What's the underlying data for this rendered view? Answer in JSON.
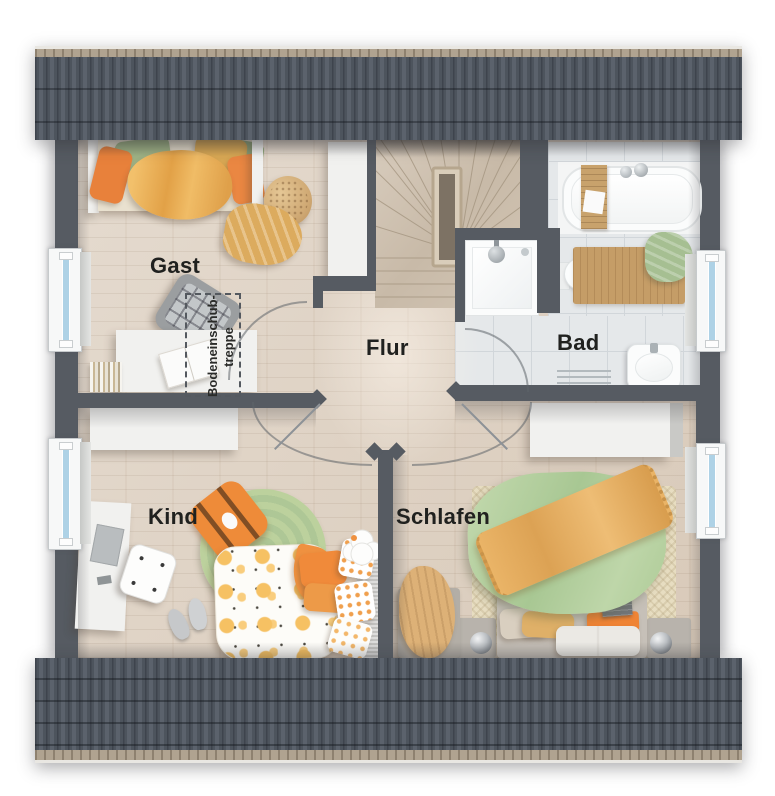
{
  "plan": {
    "rooms": {
      "gast": {
        "label": "Gast"
      },
      "flur": {
        "label": "Flur"
      },
      "bad": {
        "label": "Bad"
      },
      "kind": {
        "label": "Kind"
      },
      "schlafen": {
        "label": "Schlafen"
      }
    },
    "annotations": {
      "attic_stairs": {
        "line1": "Bodeneinschub-",
        "line2": "treppe"
      }
    },
    "colors": {
      "wall": "#565b62",
      "roof_base": "#4b525a",
      "roof_rib_dark": "#3e444d",
      "roof_eave": "#b0a390",
      "wood_floor": "#ddd0c1",
      "stair_wood": "#cdbfae",
      "tile_floor": "#e5e8ea",
      "window_glass": "#aed2e6",
      "accent_orange": "#ec8a3c",
      "accent_yellow": "#eeb55e",
      "accent_green_pillow": "#9fb386",
      "accent_green_duvet": "#b6d1a2",
      "accent_green_rug": "#b7cd98",
      "label_text": "#20211f"
    }
  }
}
